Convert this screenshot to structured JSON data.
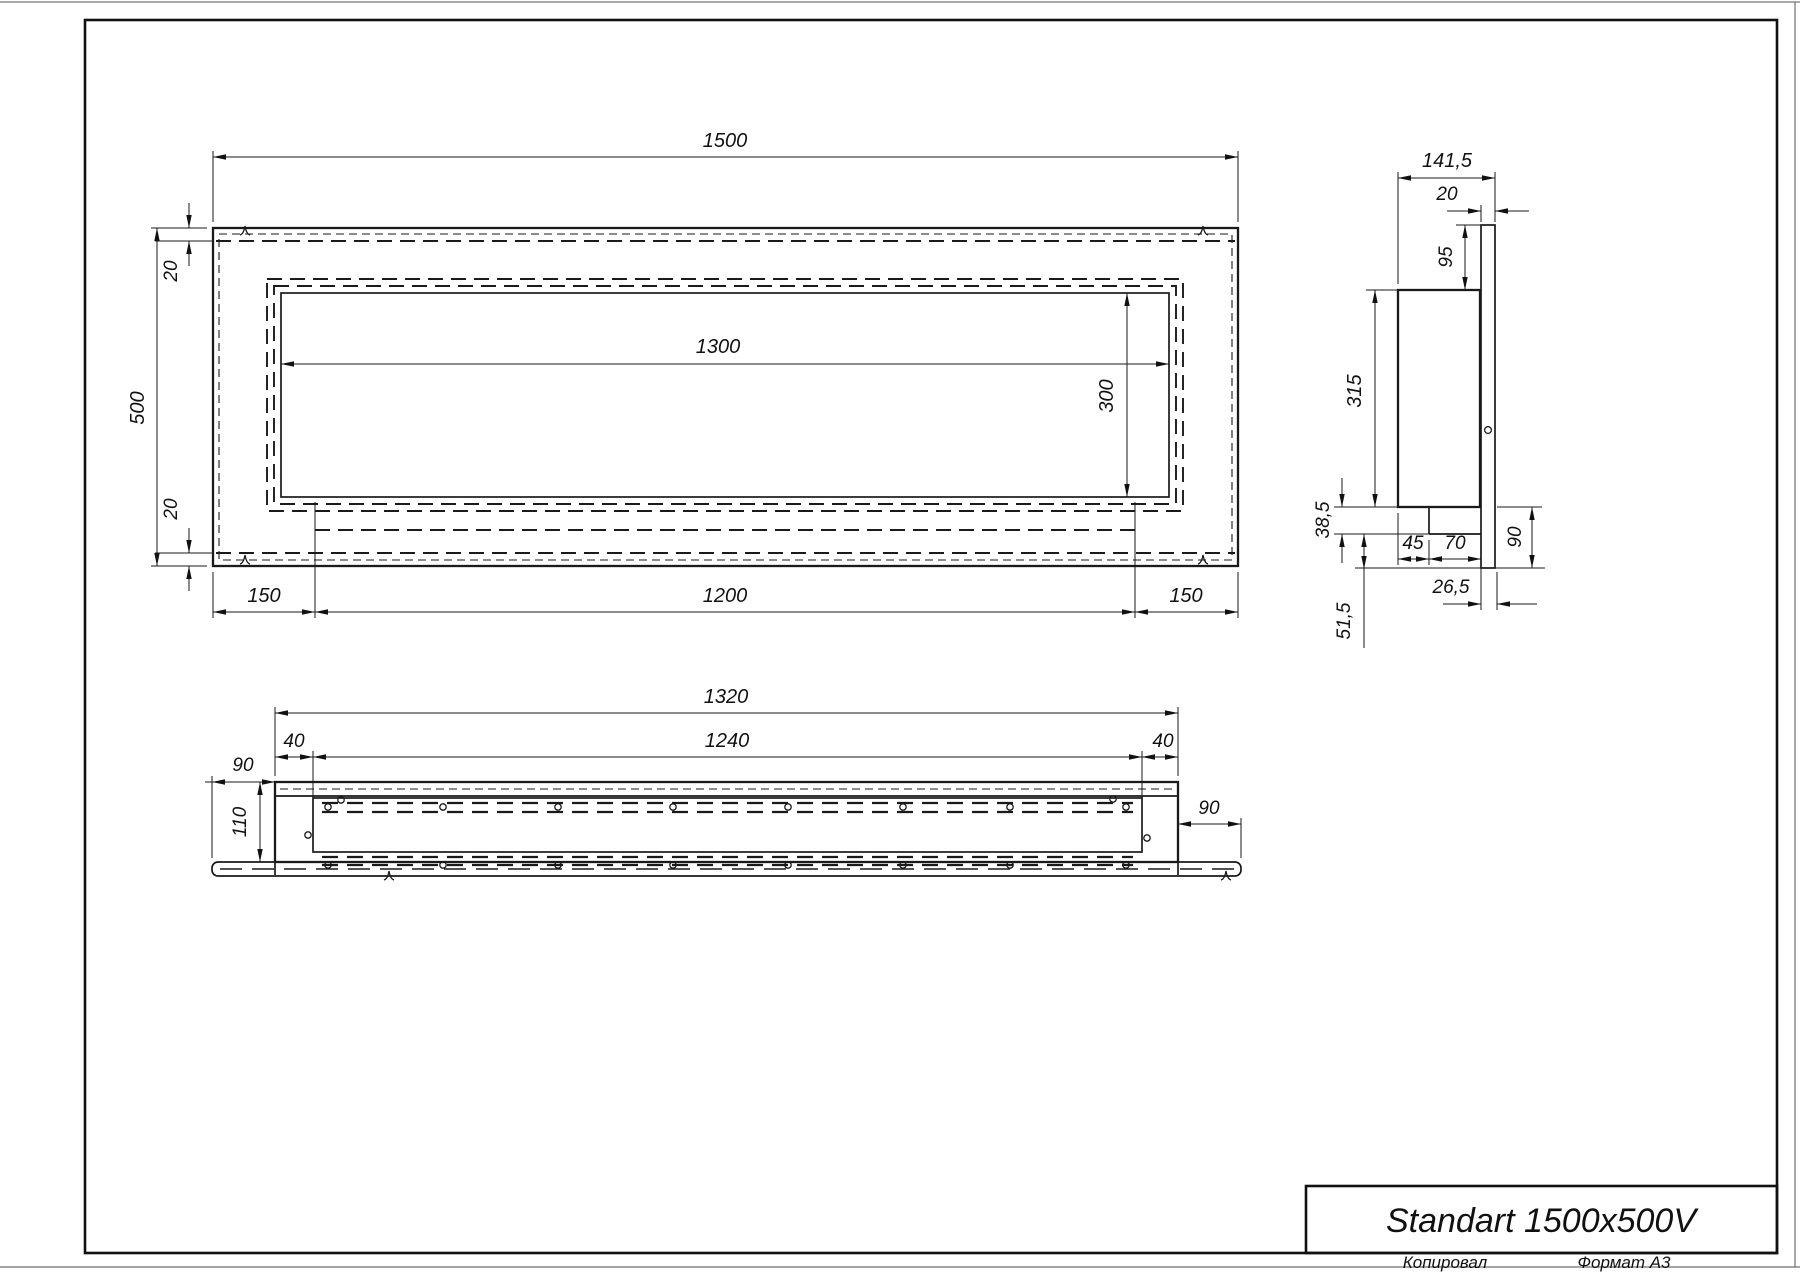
{
  "title_block": {
    "name": "Standart 1500x500V",
    "copied_label": "Копировал",
    "format_label": "Формат А3"
  },
  "front_view": {
    "width": "1500",
    "height": "500",
    "top_inset": "20",
    "bottom_inset": "20",
    "opening_width": "1300",
    "opening_height": "300",
    "left_margin": "150",
    "bottom_span": "1200",
    "right_margin": "150"
  },
  "side_view": {
    "depth": "141,5",
    "flange_thickness": "20",
    "flange_top_offset": "95",
    "body_height": "315",
    "tray_height": "38,5",
    "tray_offset": "45",
    "tray_width": "70",
    "flange_drop": "90",
    "flange_overhang": "26,5",
    "bottom_drop": "51,5"
  },
  "bottom_view": {
    "outer_width": "1320",
    "opening_width": "1240",
    "left_end": "40",
    "right_end": "40",
    "left_overhang": "90",
    "right_overhang": "90",
    "depth": "110"
  },
  "colors": {
    "line": "#1a1a1a",
    "page_edge": "#888888"
  }
}
